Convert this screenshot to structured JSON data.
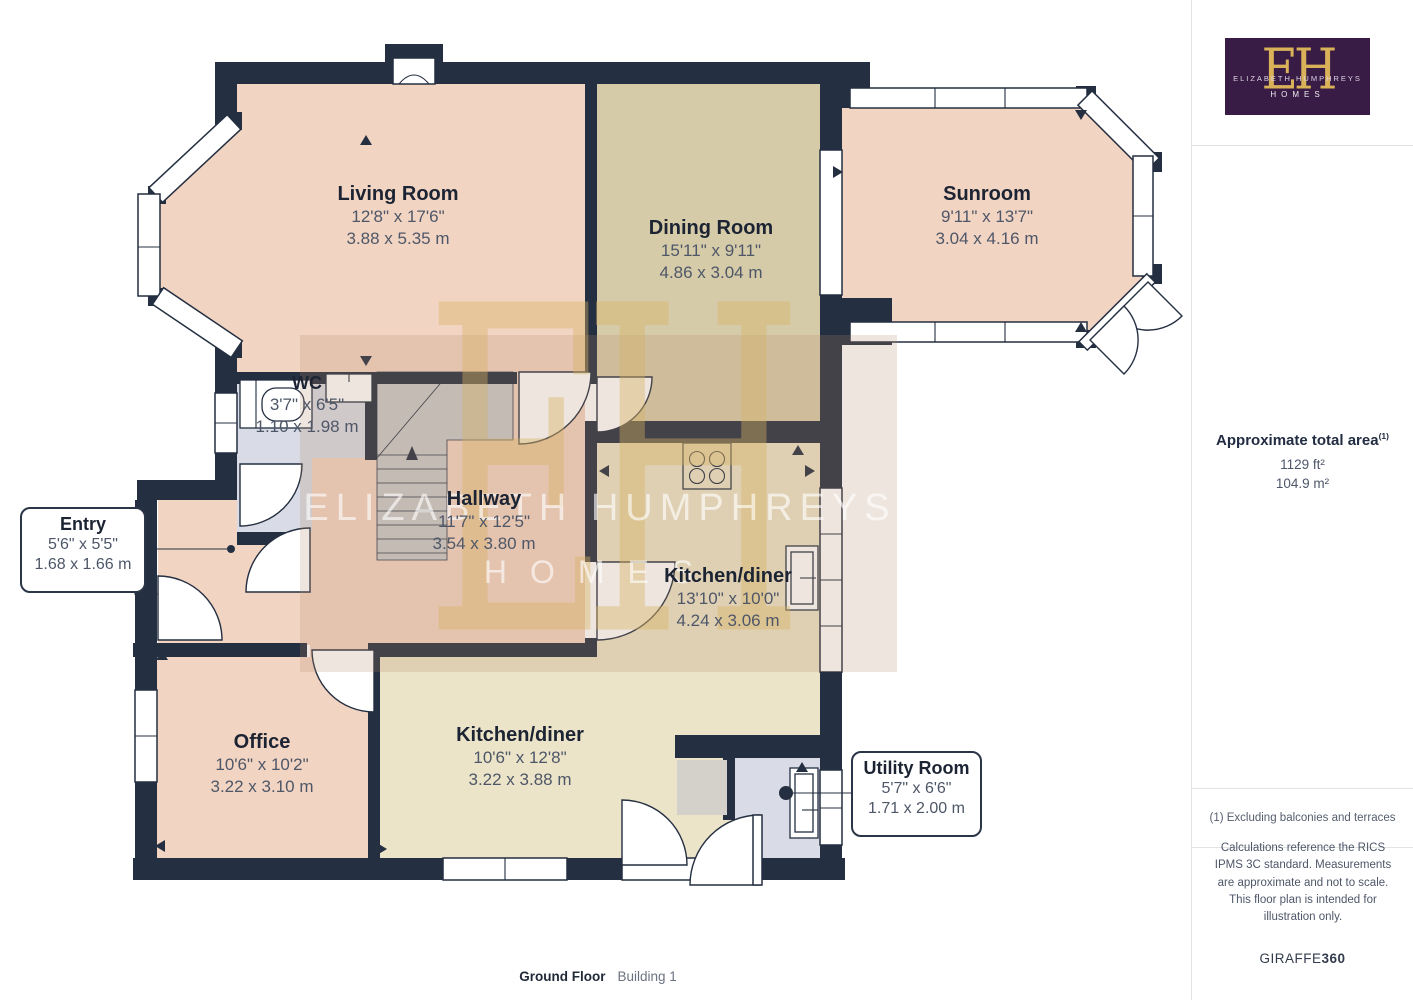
{
  "colors": {
    "wall": "#242f41",
    "salmon": "#f2d4c3",
    "tan": "#d6cba9",
    "cream": "#ece4c8",
    "greyblue": "#d9dbe6",
    "stairs": "#c9c9ca",
    "purple": "#381c45",
    "gold": "#d8b158",
    "tint": "rgba(176,138,105,0.22)"
  },
  "plan": {
    "rooms": [
      {
        "name": "Living Room",
        "imperial": "12'8\" x 17'6\"",
        "metric": "3.88 x 5.35 m"
      },
      {
        "name": "Dining Room",
        "imperial": "15'11\" x 9'11\"",
        "metric": "4.86 x 3.04 m"
      },
      {
        "name": "Sunroom",
        "imperial": "9'11\" x 13'7\"",
        "metric": "3.04 x 4.16 m"
      },
      {
        "name": "WC",
        "imperial": "3'7\" x 6'5\"",
        "metric": "1.10 x 1.98 m"
      },
      {
        "name": "Hallway",
        "imperial": "11'7\" x 12'5\"",
        "metric": "3.54 x 3.80 m"
      },
      {
        "name": "Kitchen/diner",
        "imperial": "13'10\" x 10'0\"",
        "metric": "4.24 x 3.06 m"
      },
      {
        "name": "Entry",
        "imperial": "5'6\" x 5'5\"",
        "metric": "1.68 x 1.66 m"
      },
      {
        "name": "Office",
        "imperial": "10'6\" x 10'2\"",
        "metric": "3.22 x 3.10 m"
      },
      {
        "name": "Kitchen/diner",
        "imperial": "10'6\" x 12'8\"",
        "metric": "3.22 x 3.88 m"
      },
      {
        "name": "Utility Room",
        "imperial": "5'7\" x 6'6\"",
        "metric": "1.71 x 2.00 m"
      }
    ]
  },
  "watermark": {
    "monogram": "EH",
    "line1": "ELIZABETH HUMPHREYS",
    "line2": "HOMES"
  },
  "logo": {
    "monogram": "EH",
    "line1": "ELIZABETH HUMPHREYS",
    "line2": "HOMES"
  },
  "sidebar": {
    "total_area_title": "Approximate total area",
    "total_area_marker": "(1)",
    "area_imperial": "1129 ft²",
    "area_metric": "104.9 m²",
    "footnote": "(1) Excluding balconies and terraces",
    "disclaimer": "Calculations reference the RICS IPMS 3C standard. Measurements are approximate and not to scale. This floor plan is intended for illustration only.",
    "brand_name": "GIRAFFE",
    "brand_number": "360"
  },
  "footer": {
    "floor": "Ground Floor",
    "building": "Building 1"
  }
}
